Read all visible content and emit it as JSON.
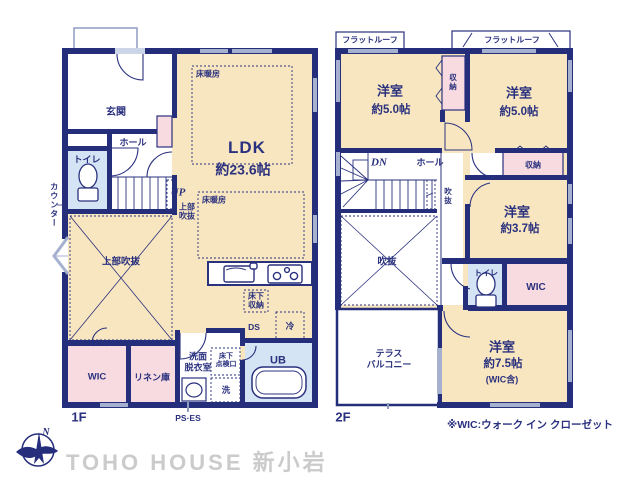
{
  "footer": {
    "floor1_label": "1F",
    "floor2_label": "2F",
    "note": "※WIC:ウォーク イン クローゼット",
    "watermark": "TOHO HOUSE 新小岩",
    "compass_n": "N"
  },
  "colors": {
    "wall": "#252e7b",
    "room_cream": "#f8e6c0",
    "closet_pink": "#f8dbe1",
    "wet_blue": "#d5e4f4",
    "window_gray": "#a6b1d0",
    "text": "#2a317e",
    "watermark": "#cbcbcb"
  },
  "floor1": {
    "genkan": "玄関",
    "hall": "ホール",
    "toilet": "トイレ",
    "counter": "カウンター",
    "ldk": "LDK",
    "ldk_size": "約23.6帖",
    "floor_heat_a": "床暖房",
    "floor_heat_b": "床暖房",
    "up": "UP",
    "void_small": "上部\n吹抜",
    "void_large": "上部吹抜",
    "underfloor_storage": "床下\n収納",
    "duct": "DS",
    "fridge": "冷",
    "wic": "WIC",
    "linen": "リネン庫",
    "washroom": "洗面\n脱衣室",
    "hatch": "床下\n点検口",
    "laundry": "洗",
    "bath": "UB",
    "ps_es": "PS·ES"
  },
  "floor2": {
    "flat_roof_l": "フラットルーフ",
    "flat_roof_r": "フラットルーフ",
    "bed1": "洋室",
    "bed1_size": "約5.0帖",
    "bed2": "洋室",
    "bed2_size": "約5.0帖",
    "closet_v": "収\n納",
    "closet_h": "収納",
    "dn": "DN",
    "hall": "ホール",
    "void_small": "吹\n抜",
    "void_large": "吹抜",
    "bed3": "洋室",
    "bed3_size": "約3.7帖",
    "toilet": "トイレ",
    "wic": "WIC",
    "terrace": "テラス\nバルコニー",
    "bed4": "洋室",
    "bed4_size": "約7.5帖",
    "bed4_note": "(WIC含)"
  }
}
